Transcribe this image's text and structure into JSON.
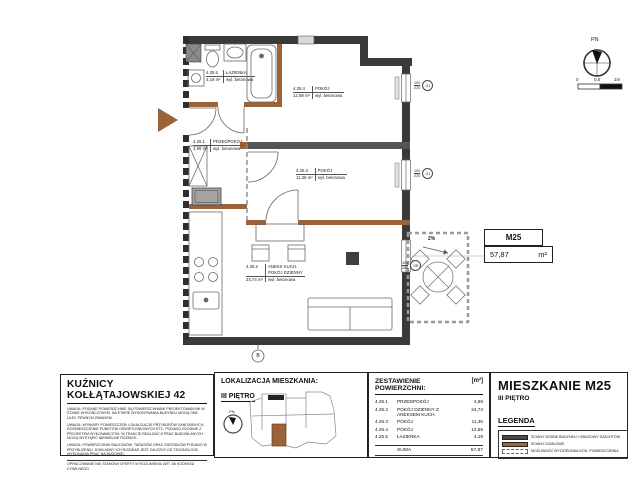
{
  "plan": {
    "area_unit": "m²",
    "compass_label": "PN",
    "scale_bar": {
      "zero": "0",
      "half": "0,5",
      "one": "1m"
    },
    "slope_label": "2%",
    "section_tag": "B",
    "unit_box": {
      "id": "M25",
      "area": "57,87",
      "unit": "m²"
    },
    "rooms": [
      {
        "no": "4.25.5",
        "name": "ŁAZIENKA",
        "area": "4,19",
        "floor": "wyl. betonowa"
      },
      {
        "no": "4.25.1",
        "name": "PRZEDPOKÓJ",
        "area": "4,99",
        "floor": "wyl. betonowa"
      },
      {
        "no": "4.25.4",
        "name": "POKÓJ",
        "area": "12,59",
        "floor": "wyl. betonowa"
      },
      {
        "no": "4.25.3",
        "name": "POKÓJ",
        "area": "11,36",
        "floor": "wyl. betonowa"
      },
      {
        "no": "4.25.2",
        "name": "ANEKS KUCH.\nPOKÓJ DZIENNY",
        "area": "24,74",
        "floor": "wyl. betonowa"
      }
    ],
    "windows": [
      {
        "w": "100",
        "h": "220",
        "tag": "O1"
      },
      {
        "w": "100",
        "h": "220",
        "tag": "O1"
      }
    ],
    "balcony_door": {
      "w": "100",
      "h": "255",
      "tag": "OB"
    }
  },
  "titleblock": {
    "address": "KUŹNICY KOŁŁĄTAJOWSKIEJ 42",
    "notes": [
      "UWAGA: PODANE POWIERZCHNIE SĄ POWIERZCHNIAMI PROJEKTOWANYMI W STANIE WYKOŃCZONYM. NA ETAPIE WYKONYWANIA BUDYNKU MOGĄ ONE ULEC PEWNYM ZMIANOM.",
      "UWAGA: WYMIARY POMIESZCZEŃ, LOKALIZACJE PRZYBORÓW SANITARNYCH, ROZMIESZCZENIE PUNKTÓW OŚWIETLENIOWYCH ETC. PODANO ZGODNIE Z PROJEKTEM WYKONAWCZYM. W TRAKCIE REALIZACJI PRAC BUDOWLANYCH MOGĄ WYSTĄPIĆ NIEWIELKIE RÓŻNICE.",
      "UWAGA: POWIERZCHNIE BALKONÓW, TARASÓW ORAZ OGRÓDKÓW PODANO W PRZYBLIŻENIU. DOKŁADNY ICH ROZMIAR JEST ZALEŻNY OD TECHNOLOGII WYKONANIA PRAC NA BUDOWIE."
    ],
    "offer_note": "OPRACOWANIE NIE STANOWI OFERTY W ROZUMIENIU ART. 66 KODEKSU CYWILNEGO",
    "location": {
      "title": "LOKALIZACJA MIESZKANIA:",
      "floor": "III PIĘTRO"
    },
    "areas": {
      "title": "ZESTAWIENIE POWIERZCHNI:",
      "unit": "[m²]",
      "rows": [
        {
          "no": "4.25.1",
          "name": "PRZEDPOKÓJ",
          "value": "4,99"
        },
        {
          "no": "4.25.2",
          "name": "POKÓJ DZIENNY Z ANEKSEM KUCH.",
          "value": "24,74"
        },
        {
          "no": "4.25.3",
          "name": "POKÓJ",
          "value": "11,36"
        },
        {
          "no": "4.25.4",
          "name": "POKÓJ",
          "value": "12,59"
        },
        {
          "no": "4.25.5",
          "name": "ŁAZIENKA",
          "value": "4,19"
        }
      ],
      "sum_label": "SUMA",
      "sum_value": "57,87"
    },
    "apartment": {
      "title": "MIESZKANIE M25",
      "floor": "III PIĘTRO",
      "legend_title": "LEGENDA",
      "legend": [
        {
          "label": "ŚCIANY NOŚNE BUDYNKU I OBUDOWY SZACHTÓW"
        },
        {
          "label": "ŚCIANY DZIAŁOWE"
        },
        {
          "label": "MOŻLIWOŚĆ WYDZIELENIA DOD. POMIESZCZENIA"
        }
      ]
    }
  },
  "colors": {
    "wall_dark": "#3a3a3a",
    "wall_partition": "#9c6239"
  }
}
